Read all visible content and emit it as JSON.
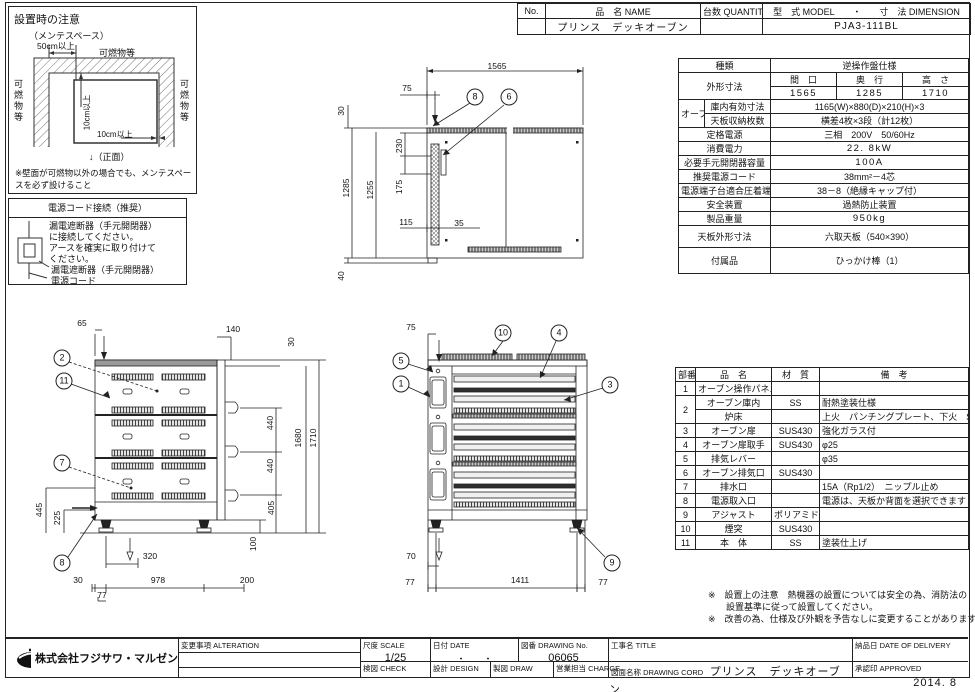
{
  "header_table": {
    "no_label": "No.",
    "name_label": "品　名 NAME",
    "qty_label": "台数 QUANTITY",
    "model_label": "型　式 MODEL　　・　　寸　法 DIMENSION",
    "name_value": "プリンス　デッキオーブン",
    "qty_value": "",
    "model_value": "PJA3-111BL"
  },
  "install_note": {
    "title": "設置時の注意",
    "maintenance": "（メンテスペース）",
    "space50": "50cm以上",
    "combustible_top": "可燃物等",
    "combustible_left": "可燃物等",
    "combustible_right": "可燃物等",
    "clear10_v": "10cm以上",
    "clear10_h": "10cm以上",
    "front_label": "↓（正面）",
    "note_line1": "※壁面が可燃物以外の場合でも、メンテスペース",
    "note_line2": "　を必ず設けること"
  },
  "power_note": {
    "title": "電源コード接続（推奨）",
    "line1": "漏電遮断器（手元開閉器）",
    "line2": "に接続してください。",
    "line3": "アースを確実に取り付けて",
    "line4": "ください。",
    "breaker_label": "漏電遮断器（手元開閉器）",
    "cord_label": "電源コード"
  },
  "spec_table": {
    "kind_label": "種類",
    "kind_value": "逆操作盤仕様",
    "dim_label": "外形寸法",
    "w_label": "間　口",
    "d_label": "奥　行",
    "h_label": "高　さ",
    "w_value": "1565",
    "d_value": "1285",
    "h_value": "1710",
    "oven_label": "オーブン",
    "inner_label": "庫内有効寸法",
    "inner_value": "1165(W)×880(D)×210(H)×3",
    "tray_label": "天板収納枚数",
    "tray_value": "横差4枚×3段（計12枚）",
    "power_label": "定格電源",
    "power_value": "三相　200V　50/60Hz",
    "consumption_label": "消費電力",
    "consumption_value": "22. 8kW",
    "breaker_label": "必要手元開閉器容量",
    "breaker_value": "100A",
    "cord_label": "推奨電源コード",
    "cord_value": "38mm²－4芯",
    "terminal_label": "電源端子台適合圧着端子",
    "terminal_value": "38－8（絶縁キャップ付）",
    "safety_label": "安全装置",
    "safety_value": "過熱防止装置",
    "weight_label": "製品重量",
    "weight_value": "950kg",
    "tray_dim_label": "天板外形寸法",
    "tray_dim_value": "六取天板（540×390）",
    "accessory_label": "付属品",
    "accessory_value": "ひっかけ棒（1）"
  },
  "parts_table": {
    "headers": [
      "部番",
      "品　名",
      "材　質",
      "備　考"
    ],
    "rows": [
      [
        "1",
        "オーブン操作パネル",
        "",
        ""
      ],
      [
        "2",
        "オーブン庫内",
        "SS",
        "耐熱塗装仕様"
      ],
      [
        "^",
        "炉床",
        "",
        "上火　パンチングプレート、下火　SS"
      ],
      [
        "3",
        "オーブン扉",
        "SUS430",
        "強化ガラス付"
      ],
      [
        "4",
        "オーブン扉取手",
        "SUS430",
        "φ25"
      ],
      [
        "5",
        "排気レバー",
        "",
        "φ35"
      ],
      [
        "6",
        "オーブン排気口",
        "SUS430",
        ""
      ],
      [
        "7",
        "排水口",
        "",
        "15A（Rp1/2）　ニップル止め"
      ],
      [
        "8",
        "電源取入口",
        "",
        "電源は、天板か背面を選択できます"
      ],
      [
        "9",
        "アジャスト",
        "ポリアミド",
        ""
      ],
      [
        "10",
        "煙突",
        "SUS430",
        ""
      ],
      [
        "11",
        "本　体",
        "SS",
        "塗装仕上げ"
      ]
    ]
  },
  "notes": {
    "line1": "※　設置上の注意　熱機器の設置については安全の為、消防法の",
    "line2": "　　設置基準に従って設置してください。",
    "line3": "※　改善の為、仕様及び外観を予告なしに変更することがあります。"
  },
  "title_block": {
    "company": "株式会社フジサワ・マルゼン",
    "alteration_label": "変更事項 ALTERATION",
    "scale_label": "尺度  SCALE",
    "scale_value": "1/25",
    "date_label": "日付  DATE",
    "date_value": "・　　・",
    "drawing_no_label": "図番  DRAWING No.",
    "drawing_no_value": "06065",
    "title_label": "工事名  TITLE",
    "delivery_label": "納品日  DATE OF DELIVERY",
    "check_label": "検図  CHECK",
    "design_label": "設計  DESIGN",
    "draw_label": "製図  DRAW",
    "charge_label": "営業担当  CHARGE",
    "drawing_name_label": "図面名称  DRAWING CORD",
    "drawing_name_value": "プリンス　デッキオーブン",
    "approved_label": "承認印  APPROVED"
  },
  "footer_date": "2014. 8",
  "drawings": {
    "plan": {
      "labels": [
        {
          "t": "1565",
          "x": 167,
          "y": 21
        },
        {
          "t": "75",
          "x": 77,
          "y": 43
        },
        {
          "t": "30",
          "x": 11,
          "y": 66,
          "r": 1
        },
        {
          "t": "230",
          "x": 69,
          "y": 101,
          "r": 1
        },
        {
          "t": "1285",
          "x": 16,
          "y": 143,
          "r": 1
        },
        {
          "t": "1255",
          "x": 40,
          "y": 145,
          "r": 1
        },
        {
          "t": "175",
          "x": 69,
          "y": 142,
          "r": 1
        },
        {
          "t": "115",
          "x": 76,
          "y": 177
        },
        {
          "t": "35",
          "x": 129,
          "y": 178
        },
        {
          "t": "40",
          "x": 11,
          "y": 231,
          "r": 1
        },
        {
          "t": "8",
          "x": 145,
          "y": 52,
          "k": "b"
        },
        {
          "t": "6",
          "x": 179,
          "y": 52,
          "k": "b"
        }
      ]
    },
    "rear": {
      "labels": [
        {
          "t": "65",
          "x": 62,
          "y": 33
        },
        {
          "t": "140",
          "x": 213,
          "y": 39
        },
        {
          "t": "30",
          "x": 271,
          "y": 52,
          "r": 1
        },
        {
          "t": "445",
          "x": 19,
          "y": 220,
          "r": 1
        },
        {
          "t": "225",
          "x": 37,
          "y": 228,
          "r": 1
        },
        {
          "t": "440",
          "x": 250,
          "y": 133,
          "r": 1
        },
        {
          "t": "440",
          "x": 250,
          "y": 176,
          "r": 1
        },
        {
          "t": "1680",
          "x": 278,
          "y": 148,
          "r": 1
        },
        {
          "t": "1710",
          "x": 293,
          "y": 148,
          "r": 1
        },
        {
          "t": "405",
          "x": 251,
          "y": 218,
          "r": 1
        },
        {
          "t": "100",
          "x": 233,
          "y": 254,
          "r": 1
        },
        {
          "t": "320",
          "x": 130,
          "y": 266
        },
        {
          "t": "30",
          "x": 58,
          "y": 290
        },
        {
          "t": "978",
          "x": 138,
          "y": 290
        },
        {
          "t": "200",
          "x": 227,
          "y": 290
        },
        {
          "t": "77",
          "x": 82,
          "y": 305
        },
        {
          "t": "2",
          "x": 42,
          "y": 68,
          "k": "b"
        },
        {
          "t": "11",
          "x": 44,
          "y": 91,
          "k": "b"
        },
        {
          "t": "7",
          "x": 42,
          "y": 173,
          "k": "b"
        },
        {
          "t": "8",
          "x": 42,
          "y": 273,
          "k": "b"
        }
      ]
    },
    "front": {
      "labels": [
        {
          "t": "75",
          "x": 31,
          "y": 37
        },
        {
          "t": "70",
          "x": 31,
          "y": 266
        },
        {
          "t": "77",
          "x": 30,
          "y": 292
        },
        {
          "t": "1411",
          "x": 140,
          "y": 290
        },
        {
          "t": "77",
          "x": 223,
          "y": 292
        },
        {
          "t": "10",
          "x": 123,
          "y": 43,
          "k": "b"
        },
        {
          "t": "4",
          "x": 179,
          "y": 43,
          "k": "b"
        },
        {
          "t": "5",
          "x": 21,
          "y": 71,
          "k": "b"
        },
        {
          "t": "1",
          "x": 21,
          "y": 94,
          "k": "b"
        },
        {
          "t": "3",
          "x": 230,
          "y": 95,
          "k": "b"
        },
        {
          "t": "9",
          "x": 232,
          "y": 273,
          "k": "b"
        }
      ]
    }
  }
}
